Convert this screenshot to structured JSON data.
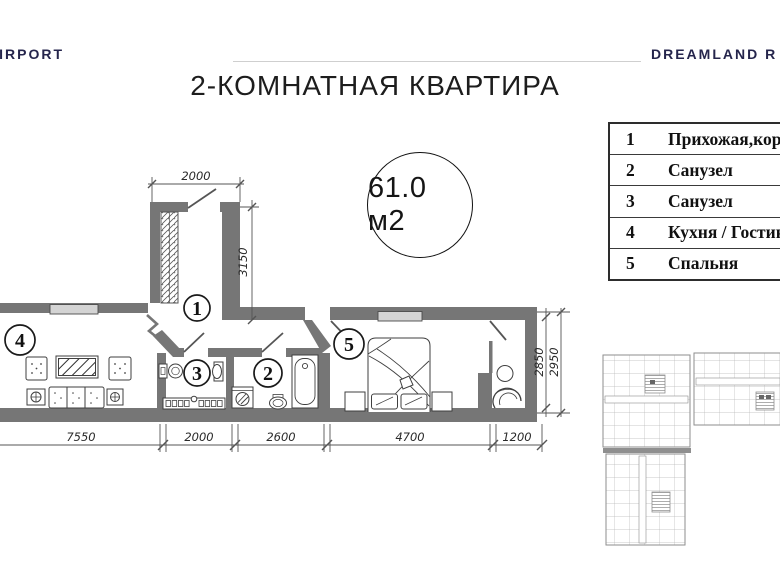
{
  "header": {
    "logo_left": "AIRPORT",
    "logo_right": "DREAMLAND R",
    "title": "2-КОМНАТНАЯ КВАРТИРА"
  },
  "area_badge": "61.0 м2",
  "legend": {
    "rows": [
      {
        "num": "1",
        "name": "Прихожая,коридор"
      },
      {
        "num": "2",
        "name": "Санузел"
      },
      {
        "num": "3",
        "name": "Санузел"
      },
      {
        "num": "4",
        "name": "Кухня / Гостиная"
      },
      {
        "num": "5",
        "name": "Спальня"
      }
    ]
  },
  "plan": {
    "rooms": {
      "r1": "1",
      "r2": "2",
      "r3": "3",
      "r4": "4",
      "r5": "5"
    },
    "dims": {
      "entry_width": "2000",
      "entry_depth": "3150",
      "bottom_1": "7550",
      "bottom_2": "2000",
      "bottom_3": "2600",
      "bottom_4": "4700",
      "bottom_5": "1200",
      "right_inner": "2850",
      "right_outer": "2950"
    },
    "colors": {
      "wall": "#767676",
      "window": "#d4d4d4",
      "line": "#3f3f3f"
    }
  }
}
